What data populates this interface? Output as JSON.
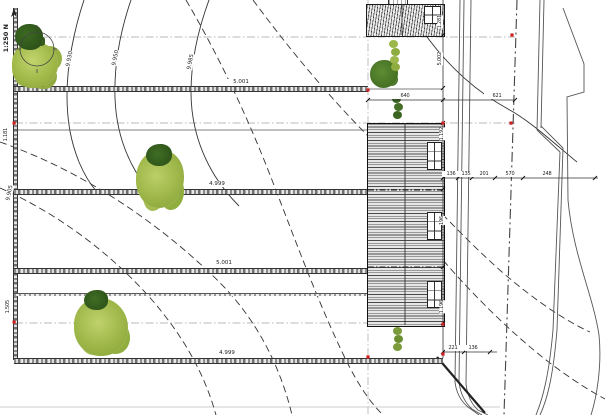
{
  "drawing": {
    "north_label": "1:250 N",
    "plot_boundary_labels": [
      "5.001",
      "4.999",
      "5.001",
      "4.999"
    ],
    "contour_labels": {
      "c1": "9.930",
      "c2": "9.950",
      "c3": "9.985",
      "left_dashed": "9.905"
    },
    "left_edge_labels": [
      "1.181",
      "1.505"
    ],
    "right_chain_labels": [
      "1.281",
      "5.002",
      "1.192",
      "196",
      "1.196"
    ],
    "top_width_labels": [
      "640",
      "621"
    ],
    "mid_chain_labels": [
      "136",
      "135",
      "201",
      "570",
      "248"
    ],
    "bottom_chain_labels": [
      "221",
      "136"
    ],
    "colors": {
      "line": "#1a1a1a",
      "red_marker": "#cc2222",
      "foliage_light": "#a9c355",
      "foliage_dark": "#33591f",
      "hatch_gray": "#555555"
    }
  }
}
